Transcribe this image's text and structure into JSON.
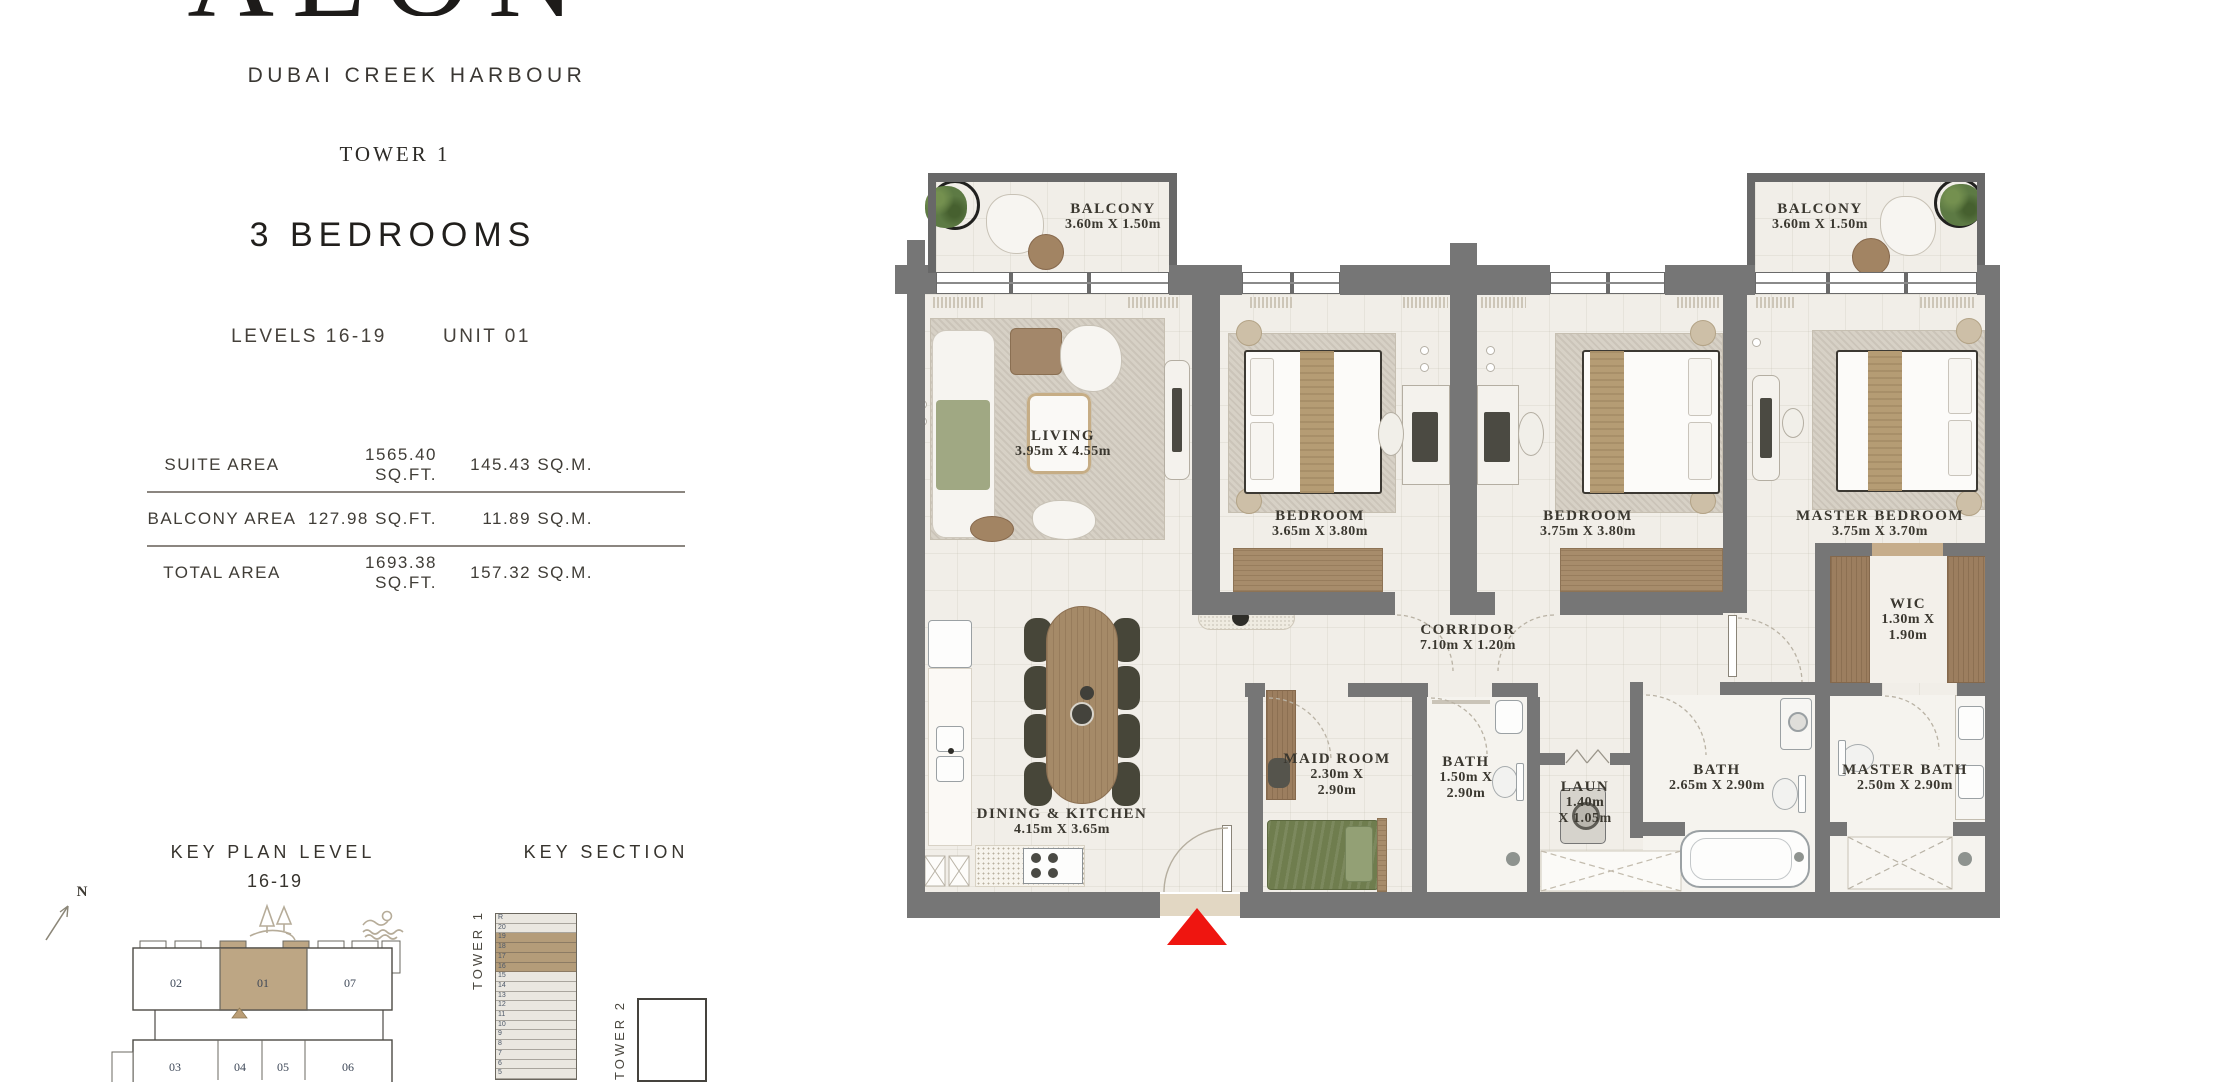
{
  "brand": {
    "logo_text": "AEON",
    "project": "DUBAI CREEK HARBOUR",
    "tower": "TOWER 1",
    "unit_type": "3 BEDROOMS",
    "levels_label": "LEVELS 16-19",
    "unit_label": "UNIT 01"
  },
  "area_table": {
    "rows": [
      {
        "label": "SUITE AREA",
        "sqft": "1565.40 SQ.FT.",
        "sqm": "145.43 SQ.M."
      },
      {
        "label": "BALCONY AREA",
        "sqft": "127.98 SQ.FT.",
        "sqm": "11.89 SQ.M."
      },
      {
        "label": "TOTAL AREA",
        "sqft": "1693.38 SQ.FT.",
        "sqm": "157.32 SQ.M."
      }
    ]
  },
  "key_plan": {
    "title": "KEY PLAN LEVEL",
    "level_range": "16-19",
    "north_label": "N",
    "units": {
      "u02": "02",
      "u01": "01",
      "u07": "07",
      "u03": "03",
      "u04": "04",
      "u05": "05",
      "u06": "06"
    },
    "highlighted_unit": "01",
    "highlight_color": "#bda684"
  },
  "key_section": {
    "title": "KEY SECTION",
    "tower1_label": "TOWER 1",
    "tower2_label": "TOWER 2",
    "floors": [
      "R",
      "20",
      "19",
      "18",
      "17",
      "16",
      "15",
      "14",
      "13",
      "12",
      "11",
      "10",
      "9",
      "8",
      "7",
      "6",
      "5"
    ],
    "highlighted_floors": [
      "19",
      "18",
      "17",
      "16"
    ],
    "highlight_color": "#b49c79"
  },
  "plan": {
    "entrance_color": "#ef1510",
    "wall_color": "#767676",
    "rooms": {
      "balcony_left": {
        "name": "BALCONY",
        "dims": "3.60m X 1.50m"
      },
      "balcony_right": {
        "name": "BALCONY",
        "dims": "3.60m X 1.50m"
      },
      "living": {
        "name": "LIVING",
        "dims": "3.95m X 4.55m"
      },
      "bedroom1": {
        "name": "BEDROOM",
        "dims": "3.65m X 3.80m"
      },
      "bedroom2": {
        "name": "BEDROOM",
        "dims": "3.75m X 3.80m"
      },
      "master_bedroom": {
        "name": "MASTER BEDROOM",
        "dims": "3.75m X 3.70m"
      },
      "corridor": {
        "name": "CORRIDOR",
        "dims": "7.10m X 1.20m"
      },
      "wic": {
        "name": "WIC",
        "dims_l1": "1.30m X",
        "dims_l2": "1.90m"
      },
      "dining_kitchen": {
        "name": "DINING & KITCHEN",
        "dims": "4.15m X 3.65m"
      },
      "maid_room": {
        "name": "MAID ROOM",
        "dims_l1": "2.30m X",
        "dims_l2": "2.90m"
      },
      "bath1": {
        "name": "BATH",
        "dims_l1": "1.50m X",
        "dims_l2": "2.90m"
      },
      "laundry": {
        "name": "LAUN",
        "dims_l1": "1.40m",
        "dims_l2": "X 1.05m"
      },
      "bath2": {
        "name": "BATH",
        "dims": "2.65m X 2.90m"
      },
      "master_bath": {
        "name": "MASTER BATH",
        "dims": "2.50m X 2.90m"
      }
    }
  }
}
